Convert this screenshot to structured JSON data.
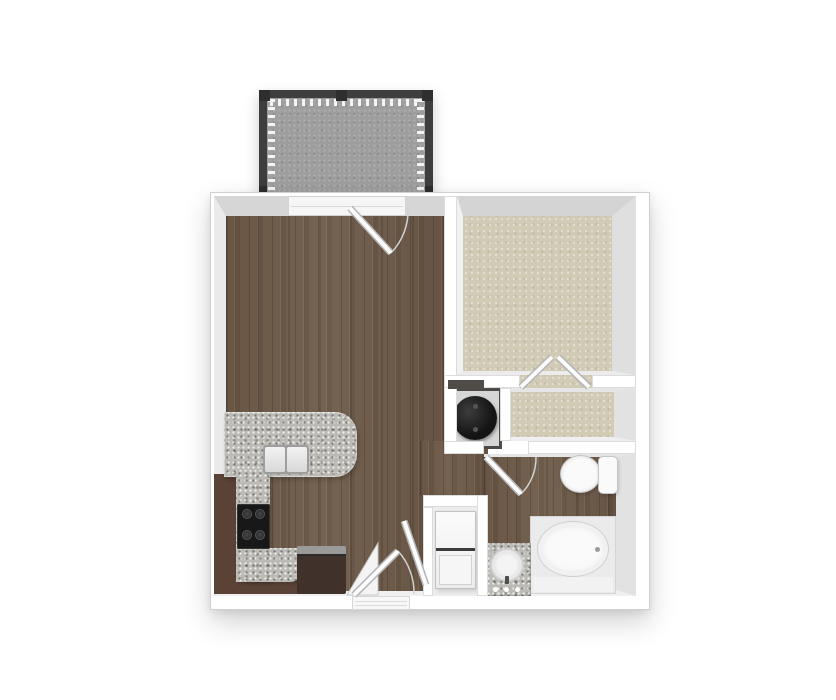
{
  "meta": {
    "title": "One-bedroom apartment 3D floor plan (top-down render)",
    "canvas": {
      "width": 836,
      "height": 700
    }
  },
  "colors": {
    "background": "#FFFFFF",
    "wall": "#FFFFFF",
    "wall_outline": "#DCDCDC",
    "bevel_dark": "#D6D6D6",
    "bevel_light": "#EAEAEA",
    "wood": "#6E5A48",
    "carpet": "#D1CAB4",
    "concrete": "#9E9E9E",
    "granite": "#BCBAB5",
    "cabinet": "#5A4237",
    "appliance_dark": "#40312A",
    "railing": "#3E3E3E",
    "fixture_white": "#FAFAFA",
    "fixture_outline": "#C6C6C6",
    "stove": "#181818",
    "water_heater": "#141414"
  },
  "rooms": {
    "living": {
      "name": "Living Room",
      "flooring": "hardwood"
    },
    "kitchen": {
      "name": "Kitchen",
      "flooring": "hardwood"
    },
    "bedroom": {
      "name": "Bedroom",
      "flooring": "carpet"
    },
    "closet": {
      "name": "Bedroom Closet",
      "flooring": "carpet"
    },
    "bathroom": {
      "name": "Bathroom",
      "flooring": "hardwood"
    },
    "hallway": {
      "name": "Entry Hall",
      "flooring": "hardwood"
    },
    "laundry": {
      "name": "Laundry Closet",
      "flooring": "vinyl"
    },
    "utility": {
      "name": "Water Heater Closet",
      "flooring": "vinyl"
    },
    "balcony": {
      "name": "Balcony",
      "flooring": "concrete"
    }
  },
  "fixtures": {
    "kitchen_sink": {
      "name": "Double-basin kitchen sink"
    },
    "stove": {
      "name": "Range / stove top"
    },
    "refrigerator": {
      "name": "Refrigerator"
    },
    "counters": {
      "name": "Granite countertops"
    },
    "toilet": {
      "name": "Toilet"
    },
    "bathtub": {
      "name": "Bathtub"
    },
    "vanity": {
      "name": "Vanity with sink"
    },
    "washer_dryer": {
      "name": "Stacked washer / dryer"
    },
    "water_heater": {
      "name": "Water heater"
    },
    "railing": {
      "name": "Balcony railing with balusters"
    }
  },
  "doors": {
    "entry": {
      "name": "Entry door",
      "swing": "in"
    },
    "balcony": {
      "name": "Balcony door",
      "swing": "in"
    },
    "bathroom": {
      "name": "Bathroom door",
      "swing": "in"
    },
    "bedroom_closet": {
      "name": "Bedroom closet double doors",
      "swing": "in"
    },
    "laundry": {
      "name": "Laundry closet door",
      "swing": "out"
    }
  }
}
